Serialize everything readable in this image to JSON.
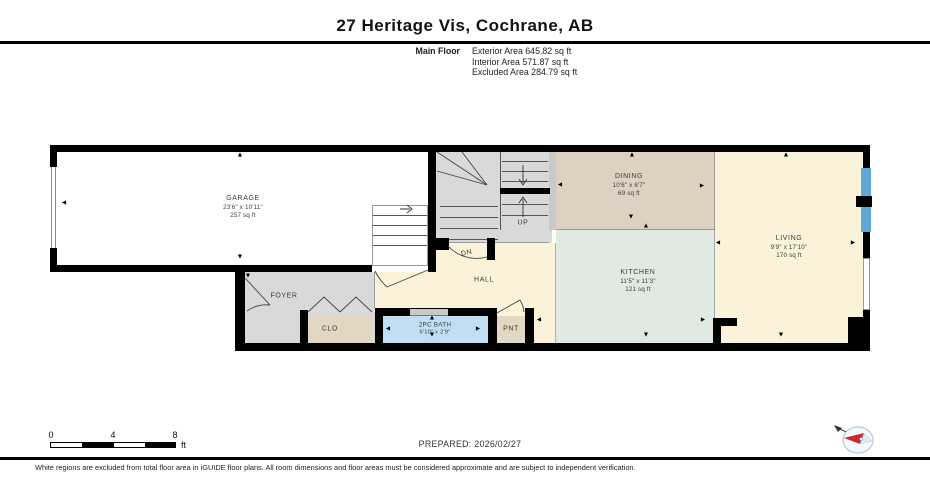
{
  "header": {
    "title": "27 Heritage Vis, Cochrane, AB",
    "floor_label": "Main Floor",
    "area_lines": [
      "Exterior Area 645.82 sq ft",
      "Interior Area 571.87 sq ft",
      "Excluded Area 284.79 sq ft"
    ]
  },
  "rooms": {
    "garage": {
      "name": "GARAGE",
      "dims": "23'6\" x 10'11\"",
      "area": "257 sq ft"
    },
    "dining": {
      "name": "DINING",
      "dims": "10'6\" x 6'7\"",
      "area": "69 sq ft"
    },
    "kitchen": {
      "name": "KITCHEN",
      "dims": "11'5\" x 11'3\"",
      "area": "121 sq ft"
    },
    "living": {
      "name": "LIVING",
      "dims": "9'9\" x 17'10\"",
      "area": "170 sq ft"
    },
    "bath": {
      "name": "2PC BATH",
      "dims": "6'10\" x 2'9\""
    },
    "foyer": {
      "name": "FOYER"
    },
    "closet": {
      "name": "CLO"
    },
    "pantry": {
      "name": "PNT"
    },
    "hall": {
      "name": "HALL"
    },
    "stairs_up": "UP",
    "stairs_down": "DN"
  },
  "icons": {
    "dim_arrow_up": "▲",
    "dim_arrow_down": "▼",
    "dim_arrow_left": "◄",
    "dim_arrow_right": "►"
  },
  "scale_bar": {
    "ticks": [
      "0",
      "4",
      "8"
    ],
    "unit": "ft"
  },
  "prepared_label": "PREPARED: 2026/02/27",
  "footer_note": "White regions are excluded from total floor area in iGUIDE floor plans. All room dimensions and floor areas must be considered approximate and are subject to independent verification.",
  "colors": {
    "wall": "#000000",
    "stairs_floor": "#d9d9d9",
    "foyer_floor": "#d9d9d9",
    "dining_floor": "#ddd2c2",
    "kitchen_floor": "#e0eae3",
    "living_hall_floor": "#faf3da",
    "bath_floor": "#c0dff2",
    "closet_floor": "#e2d7c2",
    "window": "#5fa8d7",
    "compass_needle": "#c9282d"
  }
}
